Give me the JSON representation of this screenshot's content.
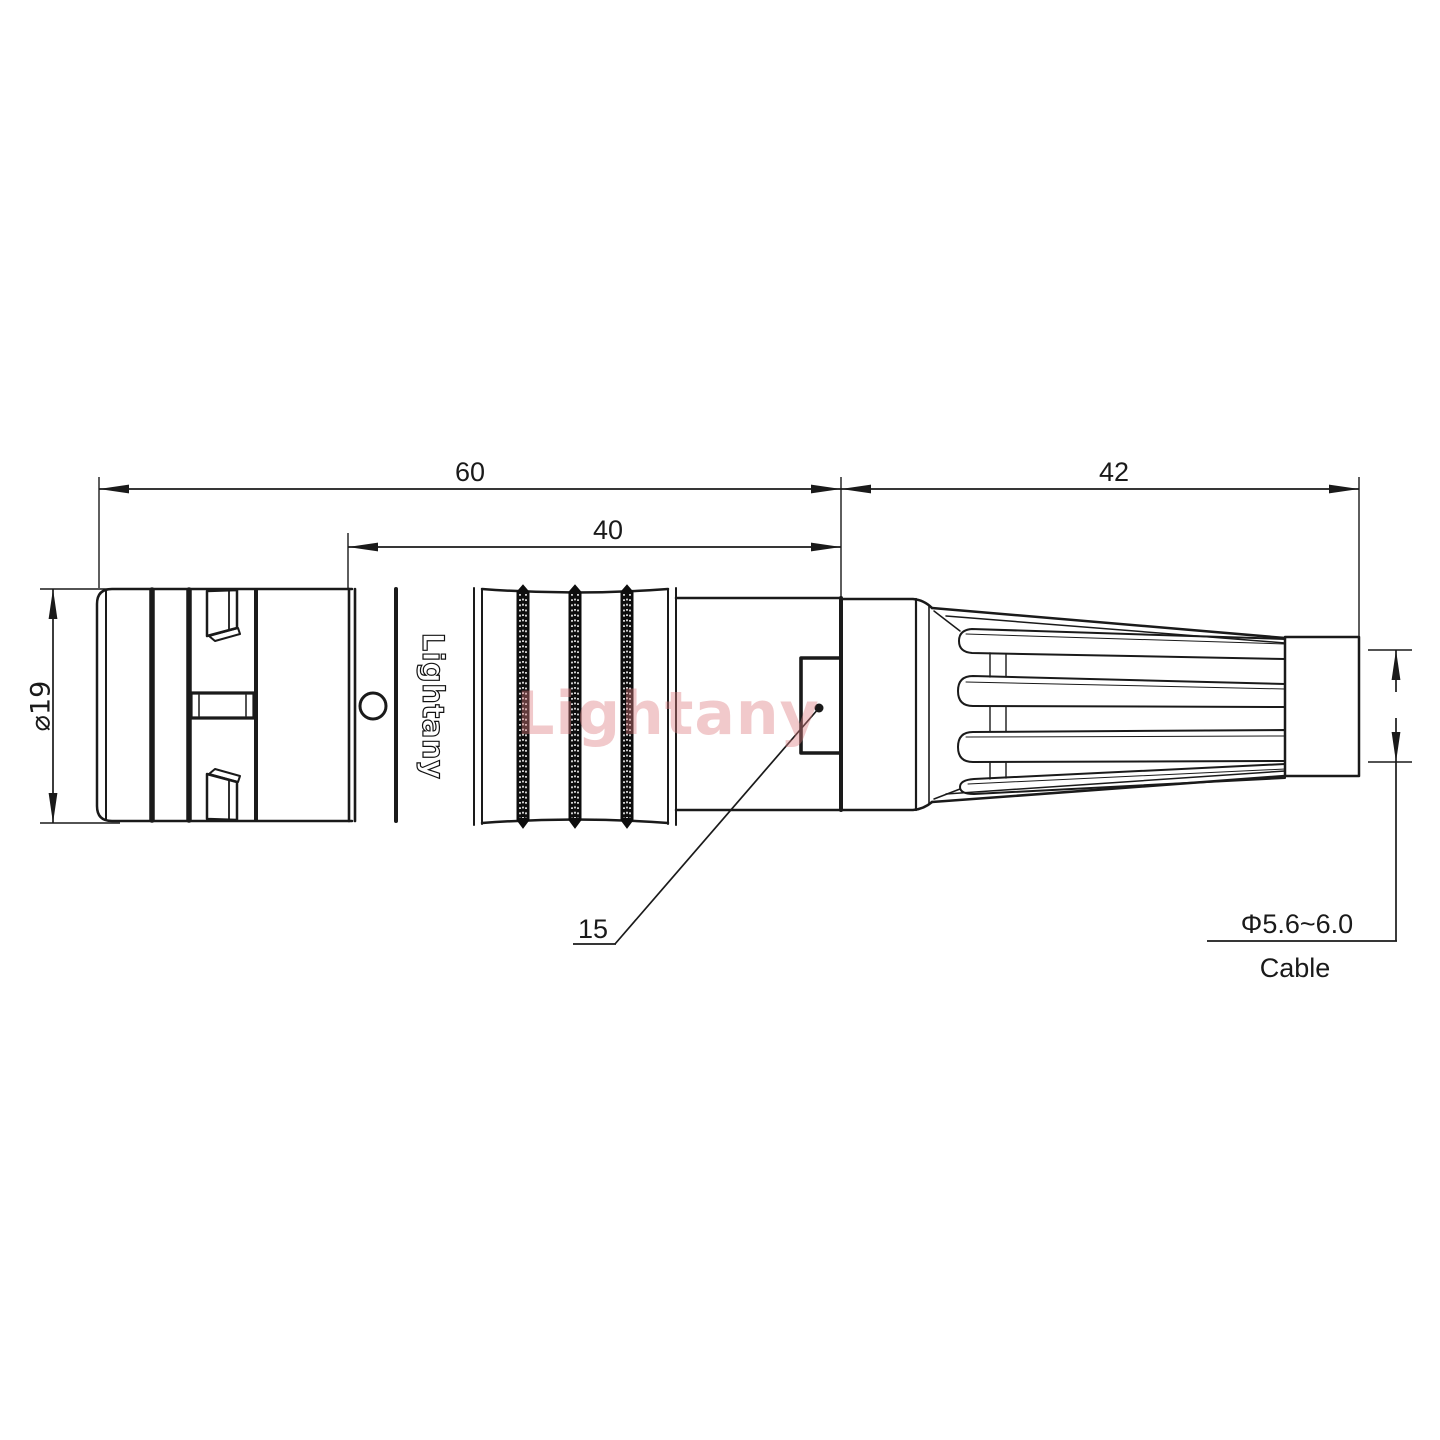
{
  "drawing": {
    "dimensions": {
      "total_length": "60",
      "mid_length": "40",
      "boot_length": "42",
      "body_diameter": "⌀19",
      "latch_ref": "15",
      "cable_range": "Φ5.6~6.0",
      "cable_label": "Cable"
    },
    "branding": {
      "body_text": "Lightany",
      "watermark_text": "Lightany"
    },
    "colors": {
      "line": "#1a1a1a",
      "watermark": "#dd7b7e",
      "background": "#ffffff"
    }
  }
}
